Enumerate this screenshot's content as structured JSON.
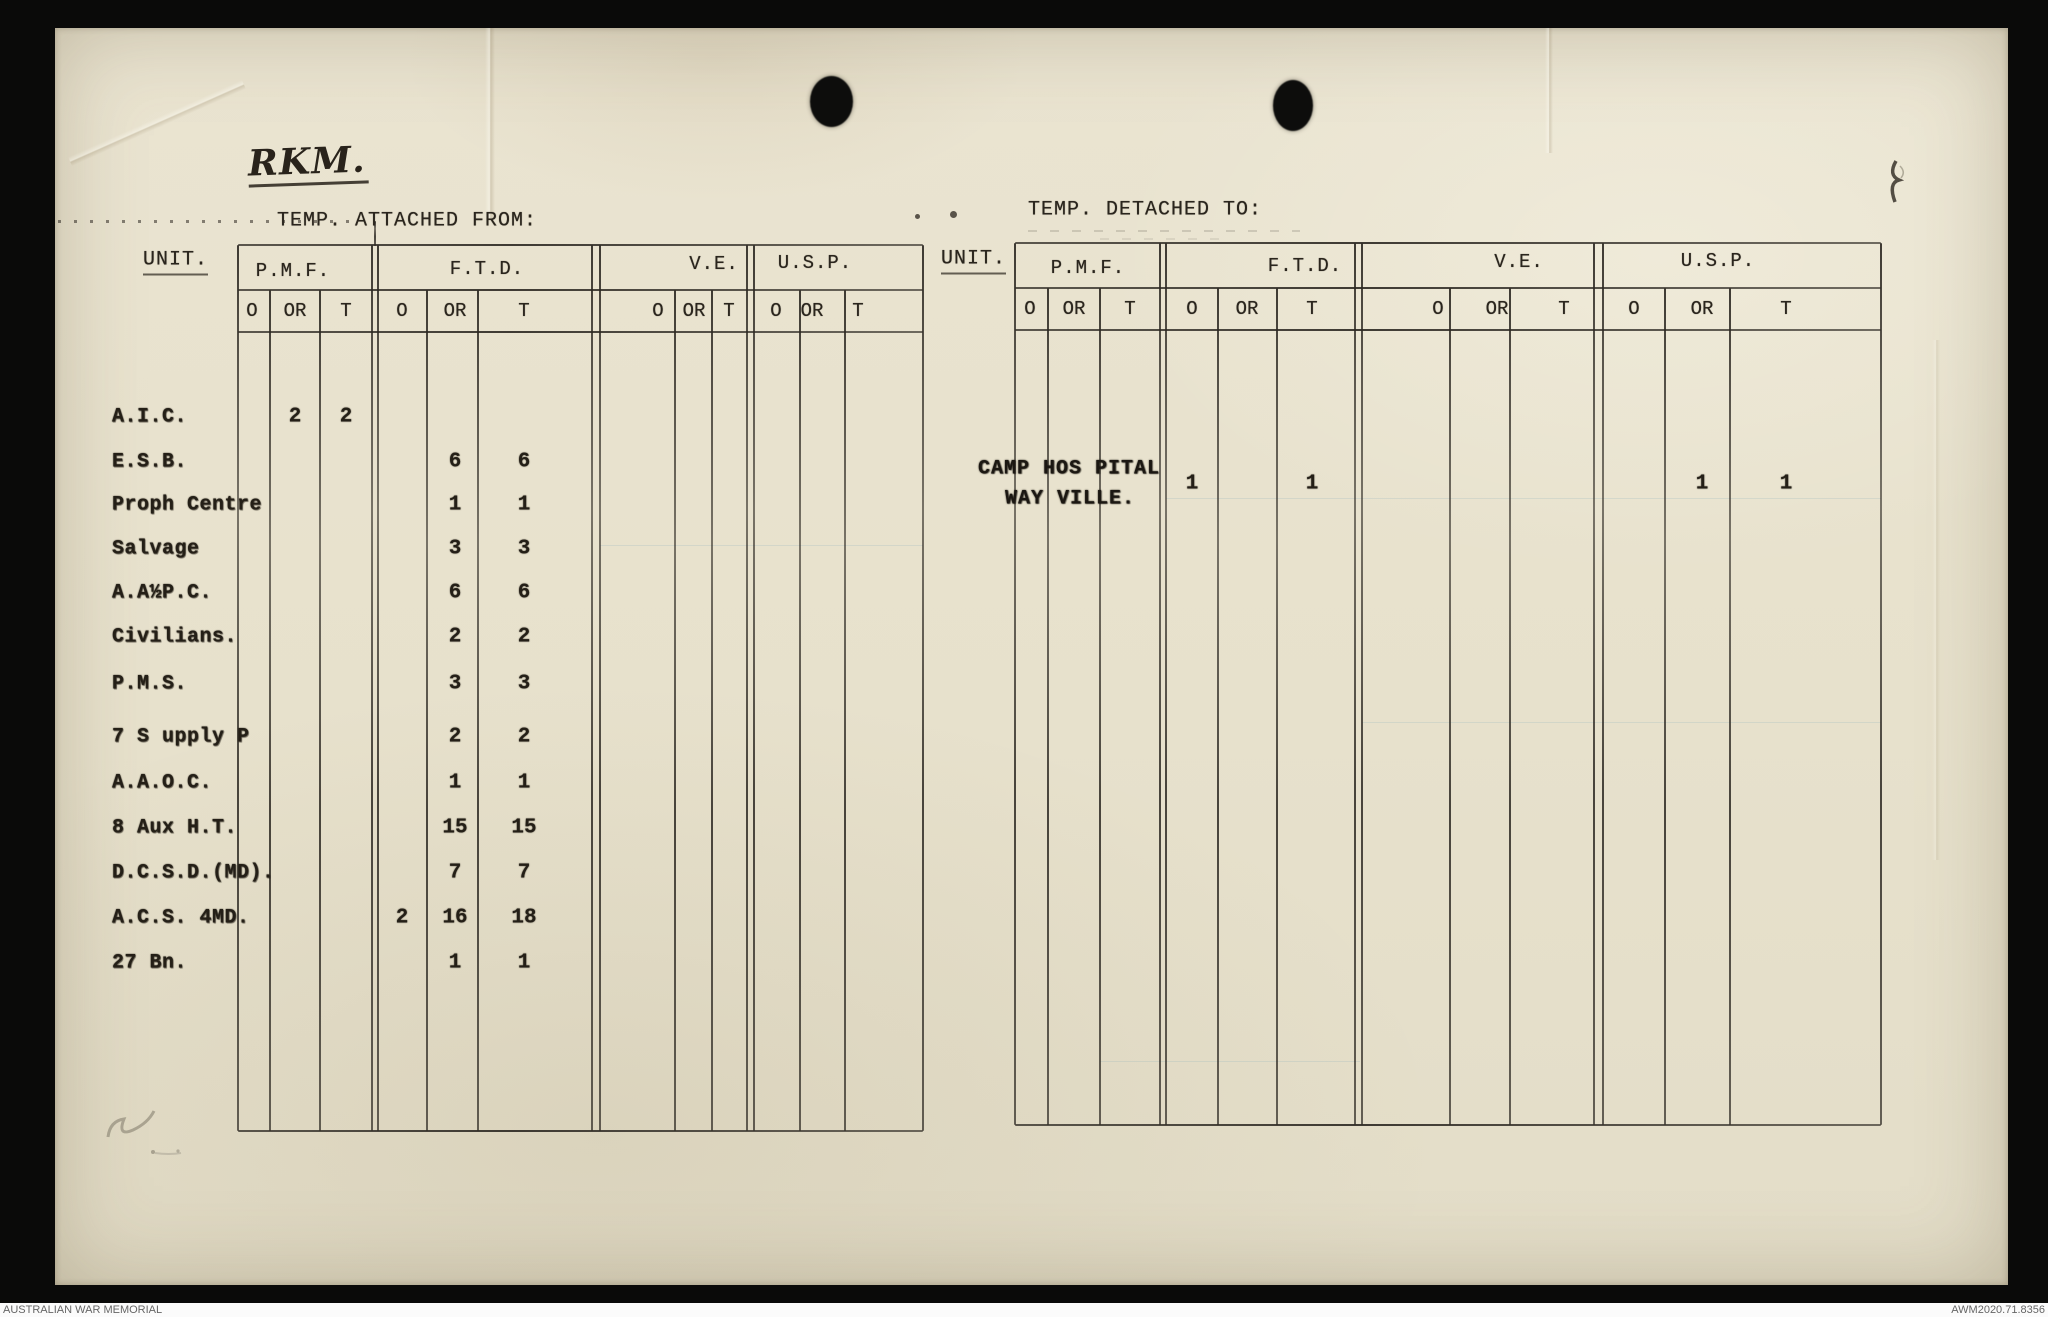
{
  "colors": {
    "paper": "#e8e2cd",
    "ink": "#2a251d",
    "table_line": "#2c2822",
    "scan_border": "#0a0a09",
    "footer_text": "#666666"
  },
  "page": {
    "handwritten_initials": "RKM.",
    "footer": {
      "left": "AUSTRALIAN WAR MEMORIAL",
      "right": "AWM2020.71.8356"
    }
  },
  "tables": {
    "attached": {
      "title": "TEMP. ATTACHED FROM:",
      "unit_header": "UNIT.",
      "sections": [
        "P.M.F.",
        "F.T.D.",
        "V.E.",
        "U.S.P."
      ],
      "sub_headers": [
        "O",
        "OR",
        "T"
      ],
      "rows": [
        {
          "unit": "A.I.C.",
          "cells": {
            "pmf_or": "2",
            "pmf_t": "2"
          }
        },
        {
          "unit": "E.S.B.",
          "cells": {
            "ftd_or": "6",
            "ftd_t": "6"
          }
        },
        {
          "unit": "Proph Centre",
          "cells": {
            "ftd_or": "1",
            "ftd_t": "1"
          }
        },
        {
          "unit": "Salvage",
          "cells": {
            "ftd_or": "3",
            "ftd_t": "3"
          }
        },
        {
          "unit": "A.A½P.C.",
          "cells": {
            "ftd_or": "6",
            "ftd_t": "6"
          }
        },
        {
          "unit": "Civilians.",
          "cells": {
            "ftd_or": "2",
            "ftd_t": "2"
          }
        },
        {
          "unit": "P.M.S.",
          "cells": {
            "ftd_or": "3",
            "ftd_t": "3"
          }
        },
        {
          "unit": "7 S upply P",
          "cells": {
            "ftd_or": "2",
            "ftd_t": "2"
          }
        },
        {
          "unit": "A.A.O.C.",
          "cells": {
            "ftd_or": "1",
            "ftd_t": "1"
          }
        },
        {
          "unit": "8 Aux H.T.",
          "cells": {
            "ftd_or": "15",
            "ftd_t": "15"
          }
        },
        {
          "unit": "D.C.S.D.(MD).",
          "cells": {
            "ftd_or": "7",
            "ftd_t": "7"
          }
        },
        {
          "unit": "A.C.S. 4MD.",
          "cells": {
            "ftd_o": "2",
            "ftd_or": "16",
            "ftd_t": "18"
          }
        },
        {
          "unit": "27 Bn.",
          "cells": {
            "ftd_or": "1",
            "ftd_t": "1"
          }
        }
      ]
    },
    "detached": {
      "title": "TEMP. DETACHED TO:",
      "unit_header": "UNIT.",
      "sections": [
        "P.M.F.",
        "F.T.D.",
        "V.E.",
        "U.S.P."
      ],
      "sub_headers": [
        "O",
        "OR",
        "T"
      ],
      "rows": [
        {
          "unit_lines": [
            "CAMP HOS PITAL",
            "WAY VILLE."
          ],
          "cells": {
            "ftd_o": "1",
            "ftd_t": "1",
            "usp_or": "1",
            "usp_t": "1"
          }
        }
      ]
    }
  }
}
